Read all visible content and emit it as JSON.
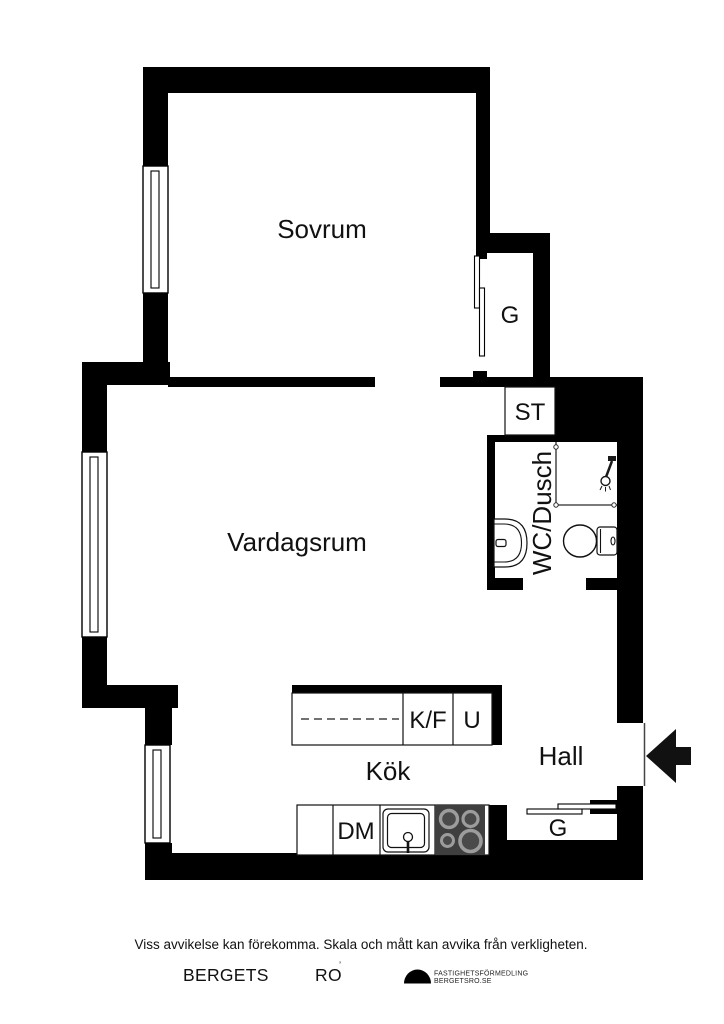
{
  "plan": {
    "labels": {
      "sovrum": "Sovrum",
      "vardagsrum": "Vardagsrum",
      "kok": "Kök",
      "hall": "Hall",
      "wc_dusch": "WC/Dusch",
      "st": "ST",
      "garderob_sovrum": "G",
      "garderob_hall": "G",
      "kyl_frys": "K/F",
      "ugn": "U",
      "diskmaskin": "DM"
    }
  },
  "footer": {
    "disclaimer": "Viss avvikelse kan förekomma. Skala och mått kan avvika från verkligheten.",
    "brand_word1": "BERGETS",
    "brand_word2": "RO",
    "brand_mark": "’",
    "agency_line1": "FASTIGHETSFÖRMEDLING",
    "agency_line2": "BERGETSRO.SE"
  },
  "colors": {
    "wall": "#000000",
    "background": "#ffffff",
    "stove_panel": "#3f3f3f",
    "burner_ring": "#9c9c9c",
    "text": "#111111"
  }
}
